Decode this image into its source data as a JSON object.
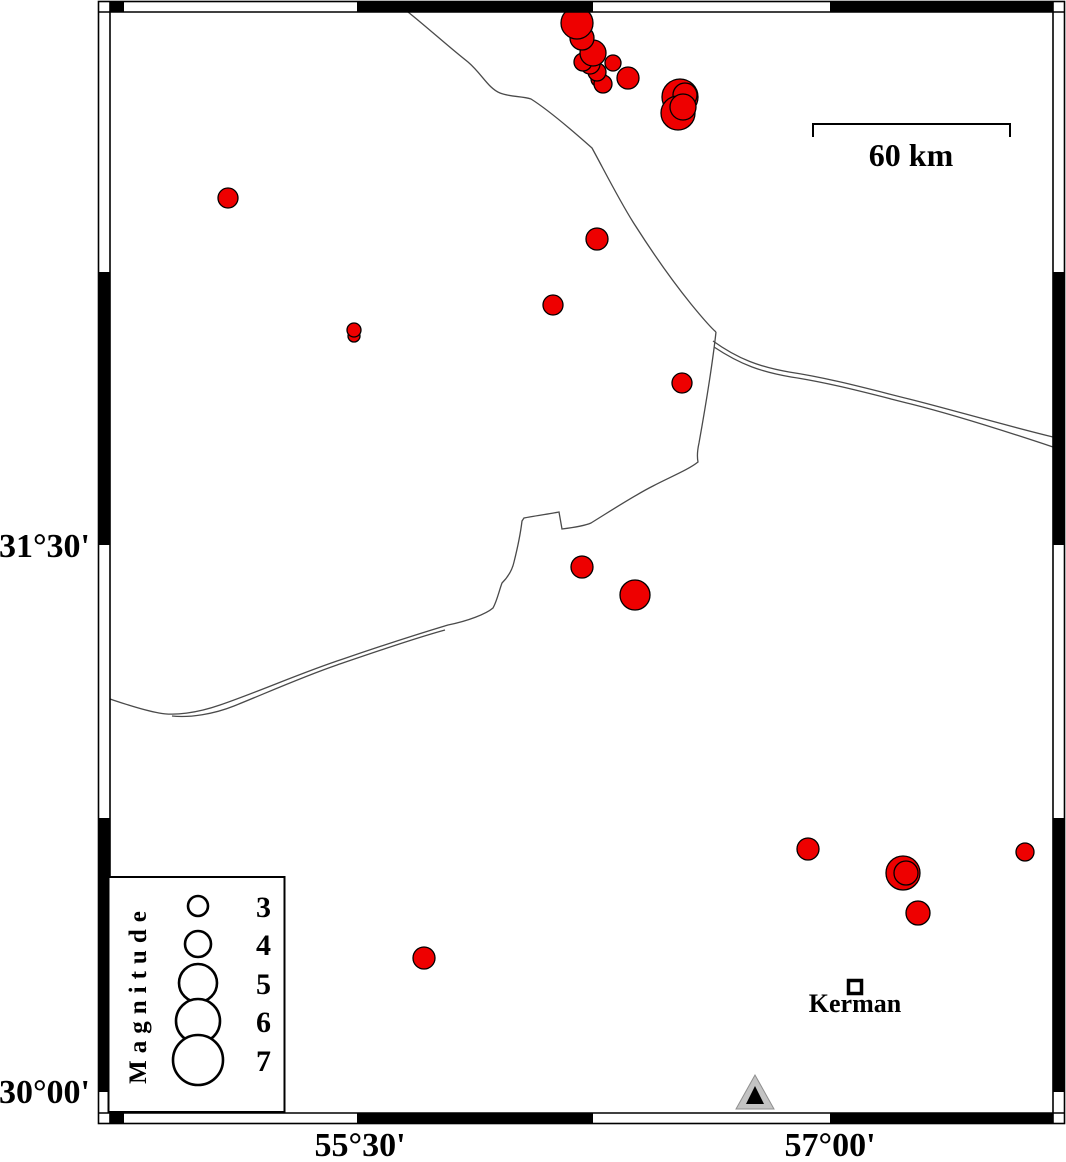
{
  "figure": {
    "type": "seismicity-map"
  },
  "colors": {
    "epicenter_fill": "#ee0000",
    "epicenter_stroke": "#000000",
    "map_line": "#4a4a4a",
    "station_outer": "#c3c3c3",
    "frame_black": "#000000"
  },
  "axis_labels": {
    "lat": [
      {
        "text": "31°30'"
      },
      {
        "text": "30°00'"
      }
    ],
    "lon": [
      {
        "text": "55°30'"
      },
      {
        "text": "57°00'"
      }
    ]
  },
  "scale_bar": {
    "label": "60 km"
  },
  "legend": {
    "title": "Magnitude",
    "entries": [
      {
        "magnitude": "3",
        "radius": 10
      },
      {
        "magnitude": "4",
        "radius": 13
      },
      {
        "magnitude": "5",
        "radius": 19
      },
      {
        "magnitude": "6",
        "radius": 22
      },
      {
        "magnitude": "7",
        "radius": 25
      }
    ]
  },
  "city": {
    "name": "Kerman"
  },
  "chart_data": {
    "type": "scatter",
    "title": "",
    "legend_position": "bottom-left",
    "epicenters_px": [
      [
        599,
        79,
        8
      ],
      [
        603,
        84,
        9
      ],
      [
        597,
        72,
        9
      ],
      [
        590,
        64,
        10
      ],
      [
        583,
        62,
        9
      ],
      [
        593,
        53,
        13
      ],
      [
        582,
        38,
        12
      ],
      [
        577,
        23,
        16
      ],
      [
        613,
        63,
        8
      ],
      [
        628,
        78,
        11
      ],
      [
        680,
        97,
        18
      ],
      [
        685,
        95,
        12
      ],
      [
        678,
        113,
        17
      ],
      [
        683,
        107,
        13
      ],
      [
        228,
        198,
        10
      ],
      [
        597,
        239,
        11
      ],
      [
        553,
        305,
        10
      ],
      [
        354,
        336,
        6
      ],
      [
        354,
        330,
        7
      ],
      [
        682,
        383,
        10
      ],
      [
        582,
        567,
        11
      ],
      [
        635,
        595,
        15
      ],
      [
        808,
        849,
        11
      ],
      [
        903,
        873,
        17
      ],
      [
        906,
        873,
        12
      ],
      [
        1025,
        852,
        9
      ],
      [
        918,
        913,
        12
      ],
      [
        424,
        958,
        11
      ]
    ],
    "map_lines_px": [
      "M 408,12 C 428,28 450,48 468,62 C 482,74 488,88 500,93 C 510,97 522,96 531,99 C 550,111 574,132 592,148 C 603,168 618,198 633,222 C 652,252 670,278 691,304 C 700,315 710,327 716,332",
      "M 713,341 C 738,359 760,367 789,372 C 829,378 869,389 909,399 C 949,409 1000,424 1053,437",
      "M 714,347 C 741,365 762,372 791,377 C 831,383 871,394 911,404 C 951,414 1002,430 1053,447",
      "M 716,332 C 712,368 704,415 699,443 C 697,452 697,457 698,462 C 688,470 670,477 653,486 C 635,495 612,510 591,523 C 584,526 570,528 562,529 L 559,512 C 549,514 534,516 524,518 L 522,521 C 520,538 517,550 514,562 C 512,571 507,578 502,583 C 499,591 497,601 493,608 C 486,614 468,621 448,625 C 418,634 378,647 343,659 C 303,672 258,692 220,705 C 197,713 174,716 159,713 C 142,710 122,703 110,699",
      "M 445,630 C 412,639 372,653 337,665 C 302,677 264,694 234,706 C 214,714 190,718 172,716"
    ]
  }
}
